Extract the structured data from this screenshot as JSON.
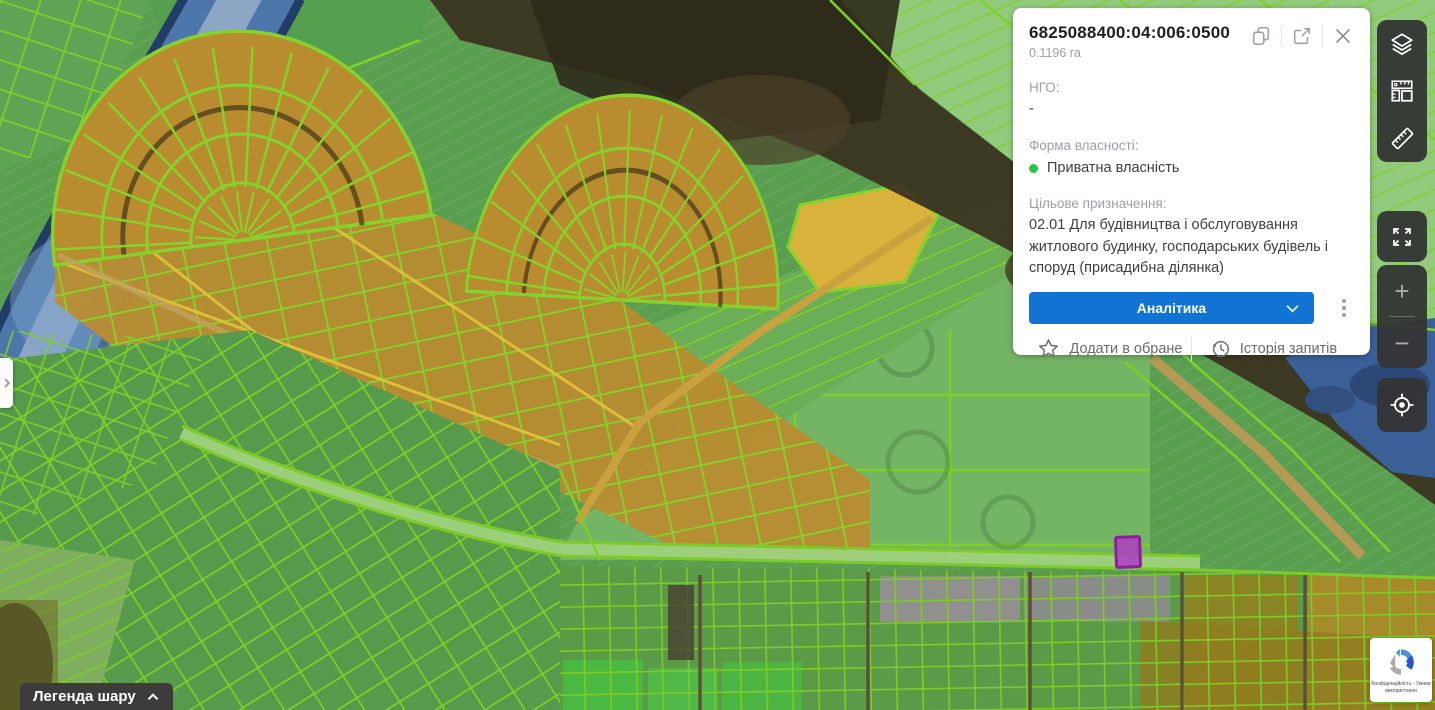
{
  "panel": {
    "parcel_id": "6825088400:04:006:0500",
    "area": "0.1196 га",
    "ngo_label": "НГО:",
    "ngo_value": "-",
    "ownership_label": "Форма власності:",
    "ownership_value": "Приватна власність",
    "purpose_label": "Цільове призначення:",
    "purpose_value": "02.01 Для будівництва і обслуговування житлового будинку, господарських будівель і споруд (присадибна ділянка)",
    "analytics_button": "Аналітика",
    "favorite_label": "Додати в обране",
    "history_label": "Історія запитів",
    "header_icons": [
      "copy-icon",
      "open-in-new-icon",
      "close-icon"
    ],
    "action_icons": [
      "star-icon",
      "history-icon"
    ],
    "menu_icon": "kebab-menu-icon",
    "button_chevron_icon": "chevron-down-icon"
  },
  "sidebar": {
    "tools": [
      "layers-icon",
      "measure-area-icon",
      "ruler-icon"
    ],
    "fullscreen_icon": "fullscreen-icon",
    "zoom_in_label": "+",
    "zoom_out_label": "−",
    "locate_icon": "locate-icon"
  },
  "legend": {
    "label": "Легенда шару",
    "chevron_icon": "chevron-up-icon"
  },
  "drawer": {
    "chevron_icon": "chevron-right-icon"
  },
  "recaptcha": {
    "line1": "Конфіденційність - Умови",
    "line2": "використання"
  },
  "map": {
    "watermark": "2025 Google",
    "selected_parcel_note": "highlighted purple parcel"
  },
  "colors": {
    "accent_blue": "#1173d2",
    "ownership_dot_green": "#27c546",
    "parcel_line_green": "#7ccf27",
    "parcel_fill_orange": "#b98c30",
    "selected_parcel_purple": "#a435b5",
    "sidebar_dark": "#343434",
    "river_blue": "#4d77ab"
  }
}
